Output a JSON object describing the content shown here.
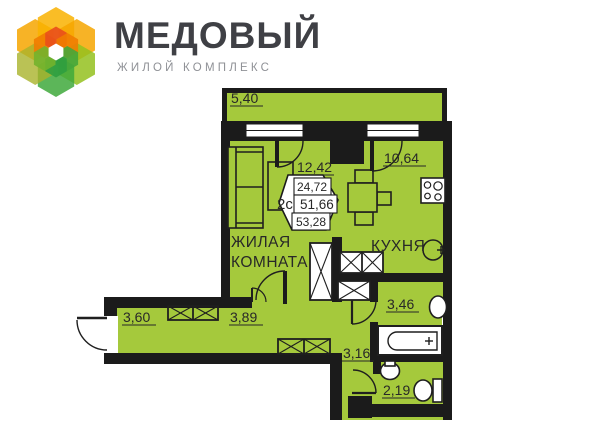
{
  "header": {
    "title": "МЕДОВЫЙ",
    "subtitle": "ЖИЛОЙ КОМПЛЕКС"
  },
  "plan": {
    "badge": {
      "unit_type": "2с",
      "row1": "24,72",
      "row2": "51,66",
      "row3": "53,28"
    },
    "labels": {
      "balcony": "5,40",
      "living_dim": "12,42",
      "kitchen_dim": "10,64",
      "hall_left": "3,60",
      "hall_main": "3,89",
      "hall_inner": "3,16",
      "bathroom": "3,46",
      "wc": "2,19",
      "living_name_line1": "ЖИЛАЯ",
      "living_name_line2": "КОМНАТА",
      "kitchen_name": "КУХНЯ"
    },
    "colors": {
      "floor": "#a5c93c",
      "wall": "#1b1b1b"
    }
  }
}
